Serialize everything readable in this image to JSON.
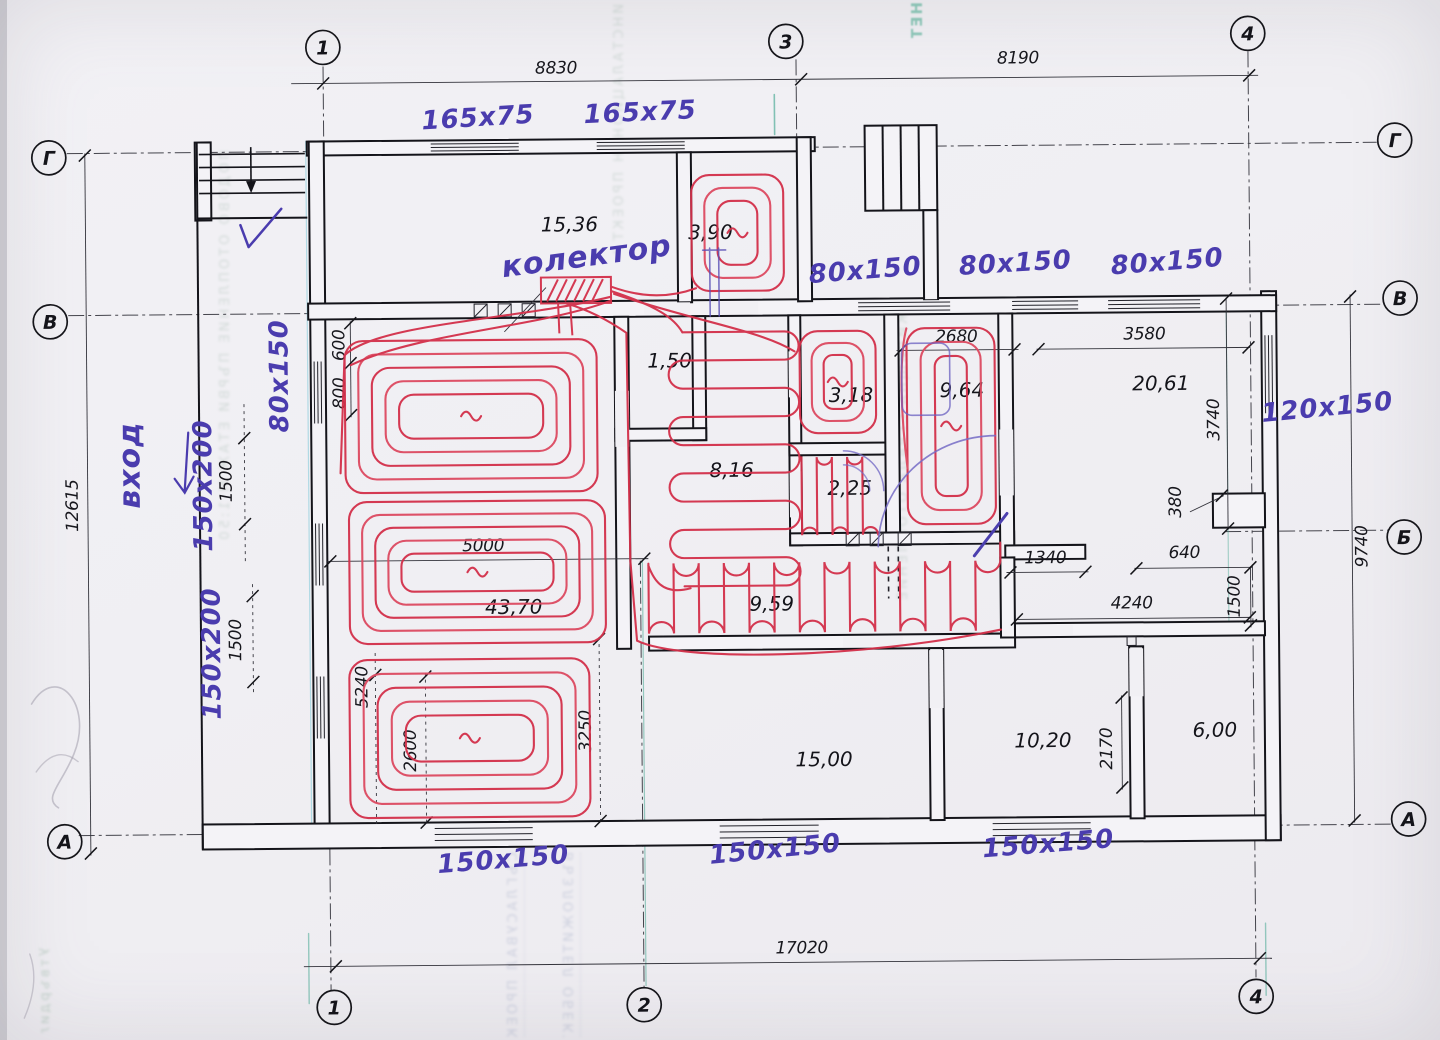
{
  "axes": {
    "v1": "1",
    "v2": "2",
    "v3": "3",
    "v4": "4",
    "hA": "А",
    "hB": "Б",
    "hV": "В",
    "hG": "Г"
  },
  "dims": {
    "d8830": "8830",
    "d8190": "8190",
    "d17020": "17020",
    "d12615": "12615",
    "d9740": "9740",
    "d2680": "2680",
    "d3580": "3580",
    "d3740": "3740",
    "d380": "380",
    "d640": "640",
    "d1500": "1500",
    "d1340": "1340",
    "d4240": "4240",
    "d2170": "2170",
    "d5000": "5000",
    "d600": "600",
    "d800": "800",
    "d5240": "5240",
    "d2600": "2600",
    "d3250": "3250"
  },
  "areas": {
    "vestibule_top": "15,36",
    "hall_top": "3,90",
    "closet": "1,50",
    "corridor": "8,16",
    "wc": "3,18",
    "bath_small": "2,25",
    "bath": "9,64",
    "room_right": "20,61",
    "living": "43,70",
    "corridor_south": "9,59",
    "room_bottom_left": "15,00",
    "room_bottom_mid": "10,20",
    "room_bottom_right": "6,00"
  },
  "ducts": {
    "d165x75": "165x75",
    "d80x150": "80x150",
    "d150x200": "150x200",
    "d120x150": "120x150",
    "d150x150": "150x150"
  },
  "notes": {
    "collector": "колектор",
    "entrance": "вход"
  },
  "bleed": {
    "left": "ПОДОВО ОТОПЛЕНИЕ ПЪРВИ ЕТАЖ М 1:50",
    "top": "ИНСТАЛАЦИОНЕН ПРОЕКТ ЧАСТ ОВК",
    "right_mid": "ЖИЛИЩНА СГРАДА ОТОПЛЕНИЕ",
    "bottom_a": "СЪГЛАСУВАЛ ПРОЕКТАНТ ЧЕРТЕЖ",
    "bottom_b": "ВЪЗЛОЖИТЕЛ ОБЕКТ ЛИСТ",
    "stamp": "НЕТ",
    "corner": "Утвърдил ТГ"
  }
}
